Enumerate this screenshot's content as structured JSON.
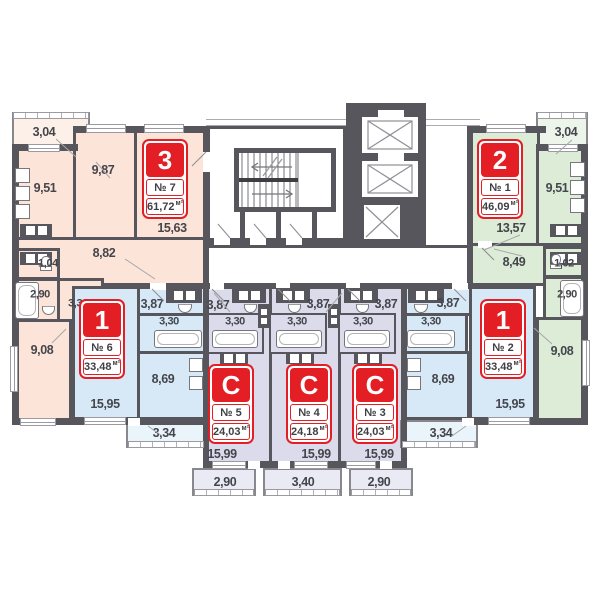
{
  "plan": {
    "kind": "residential floor plan",
    "floor_core": [
      "staircase",
      "elevators"
    ]
  },
  "colors": {
    "wall": "#56565c",
    "red": "#e31e24",
    "peach": "#fce4d8",
    "blue": "#d7e9f7",
    "lavender": "#dbdbeb",
    "green": "#dcecd7",
    "text": "#45454c"
  },
  "units": {
    "apt7": {
      "badge": "3",
      "num": "№ 7",
      "area": "61,72",
      "unit": "м²",
      "rooms": {
        "balcony": "3,04",
        "bedroom": "9,87",
        "kitchen": "9,51",
        "living": "15,63",
        "hall": "8,82",
        "wc": "1,04",
        "bath": "2,90",
        "corridor": "3,36",
        "room": "9,08"
      }
    },
    "apt6": {
      "badge": "1",
      "num": "№ 6",
      "area": "33,48",
      "unit": "м²",
      "rooms": {
        "hall": "3,87",
        "bath": "3,30",
        "kitchen": "8,69",
        "living": "15,95",
        "balcony": "3,34"
      }
    },
    "apt5": {
      "badge": "С",
      "num": "№ 5",
      "area": "24,03",
      "unit": "м²",
      "rooms": {
        "hall": "3,87",
        "bath": "3,30",
        "living": "15,99",
        "balcony": "2,90"
      }
    },
    "apt4": {
      "badge": "С",
      "num": "№ 4",
      "area": "24,18",
      "unit": "м²",
      "rooms": {
        "hall": "3,87",
        "bath": "3,30",
        "living": "15,99",
        "balcony": "3,40"
      }
    },
    "apt3": {
      "badge": "С",
      "num": "№ 3",
      "area": "24,03",
      "unit": "м²",
      "rooms": {
        "hall": "3,87",
        "bath": "3,30",
        "living": "15,99",
        "balcony": "2,90"
      }
    },
    "apt1": {
      "badge": "2",
      "num": "№ 1",
      "area": "46,09",
      "unit": "м²",
      "rooms": {
        "balcony": "3,04",
        "kitchen": "9,51",
        "living": "13,57",
        "hall": "8,49",
        "wc": "1,02",
        "bath": "2,90",
        "room": "9,08"
      }
    },
    "apt2": {
      "badge": "1",
      "num": "№ 2",
      "area": "33,48",
      "unit": "м²",
      "rooms": {
        "hall": "3,87",
        "bath": "3,30",
        "kitchen": "8,69",
        "living": "15,95",
        "balcony": "3,34"
      }
    }
  }
}
